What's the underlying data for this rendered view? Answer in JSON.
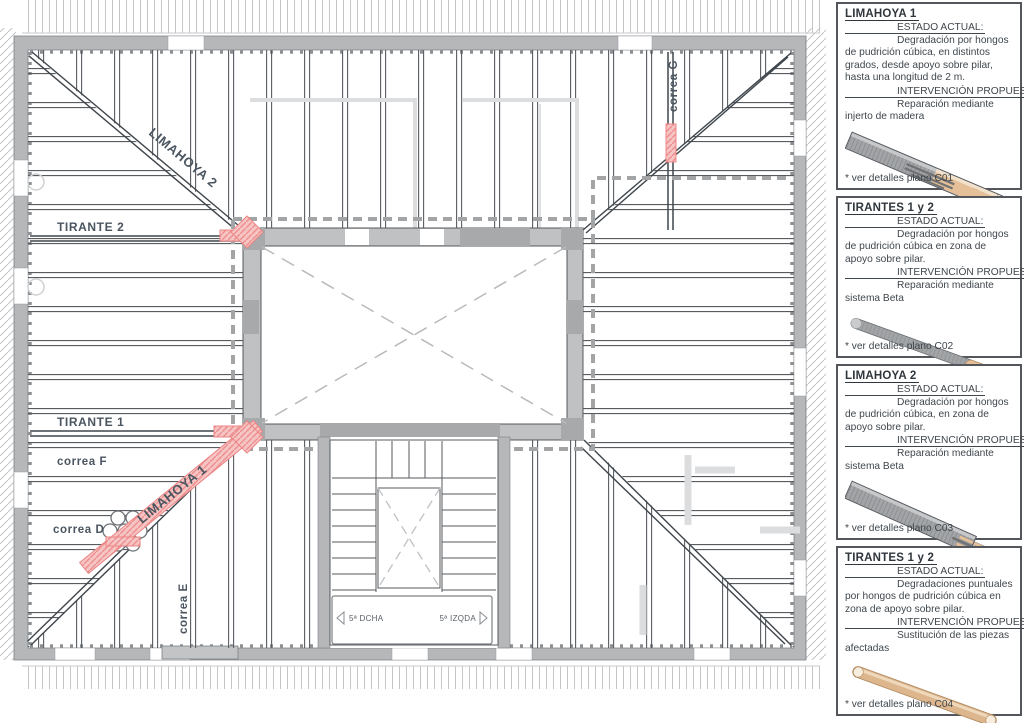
{
  "plan": {
    "labels": [
      {
        "text": "LIMAHOYA 2"
      },
      {
        "text": "TIRANTE 2"
      },
      {
        "text": "TIRANTE 1"
      },
      {
        "text": "correa F"
      },
      {
        "text": "correa D"
      },
      {
        "text": "correa E"
      },
      {
        "text": "correa G"
      },
      {
        "text": "LIMAHOYA 1"
      },
      {
        "text": "5ª DCHA"
      },
      {
        "text": "5ª IZQDA"
      }
    ],
    "colors": {
      "highlight_pink": "#f09d9d",
      "wall_gray": "#b5b7b9",
      "line_dark": "#3f464c",
      "label_color": "#4a5560"
    }
  },
  "sidebar": {
    "cards": [
      {
        "title": "LIMAHOYA 1",
        "estado_heading": "ESTADO ACTUAL:",
        "estado_text": "Degradación por hongos de pudrición cúbica, en distintos grados, desde apoyo sobre pilar, hasta una longitud de 2 m.",
        "intervencion_heading": "INTERVENCIÓN PROPUESTA:",
        "intervencion_text": "Reparación mediante injerto de madera",
        "footnote": "* ver detalles plano C01",
        "illustration": "square-beam-with-wood-graft"
      },
      {
        "title": "TIRANTES 1 y 2",
        "estado_heading": "ESTADO ACTUAL:",
        "estado_text": "Degradación por hongos de pudrición cúbica en zona de apoyo sobre pilar.",
        "intervencion_heading": "INTERVENCIÓN PROPUESTA:",
        "intervencion_text": "Reparación mediante sistema Beta",
        "footnote": "* ver detalles plano C02",
        "illustration": "round-tie-with-beta-tip"
      },
      {
        "title": "LIMAHOYA 2",
        "estado_heading": "ESTADO ACTUAL:",
        "estado_text": "Degradación por hongos de pudrición cúbica, en zona de apoyo sobre pilar.",
        "intervencion_heading": "INTERVENCIÓN PROPUESTA:",
        "intervencion_text": "Reparación mediante sistema Beta",
        "footnote": "* ver detalles plano C03",
        "illustration": "square-beam-with-beta-end"
      },
      {
        "title": "TIRANTES 1 y 2",
        "estado_heading": "ESTADO ACTUAL:",
        "estado_text": "Degradaciones puntuales por hongos de pudrición cúbica en zona de apoyo sobre pilar.",
        "intervencion_heading": "INTERVENCIÓN PROPUESTA:",
        "intervencion_text": "Sustitución de las piezas afectadas",
        "footnote": "* ver detalles plano C04",
        "illustration": "round-wood-tie"
      }
    ]
  }
}
